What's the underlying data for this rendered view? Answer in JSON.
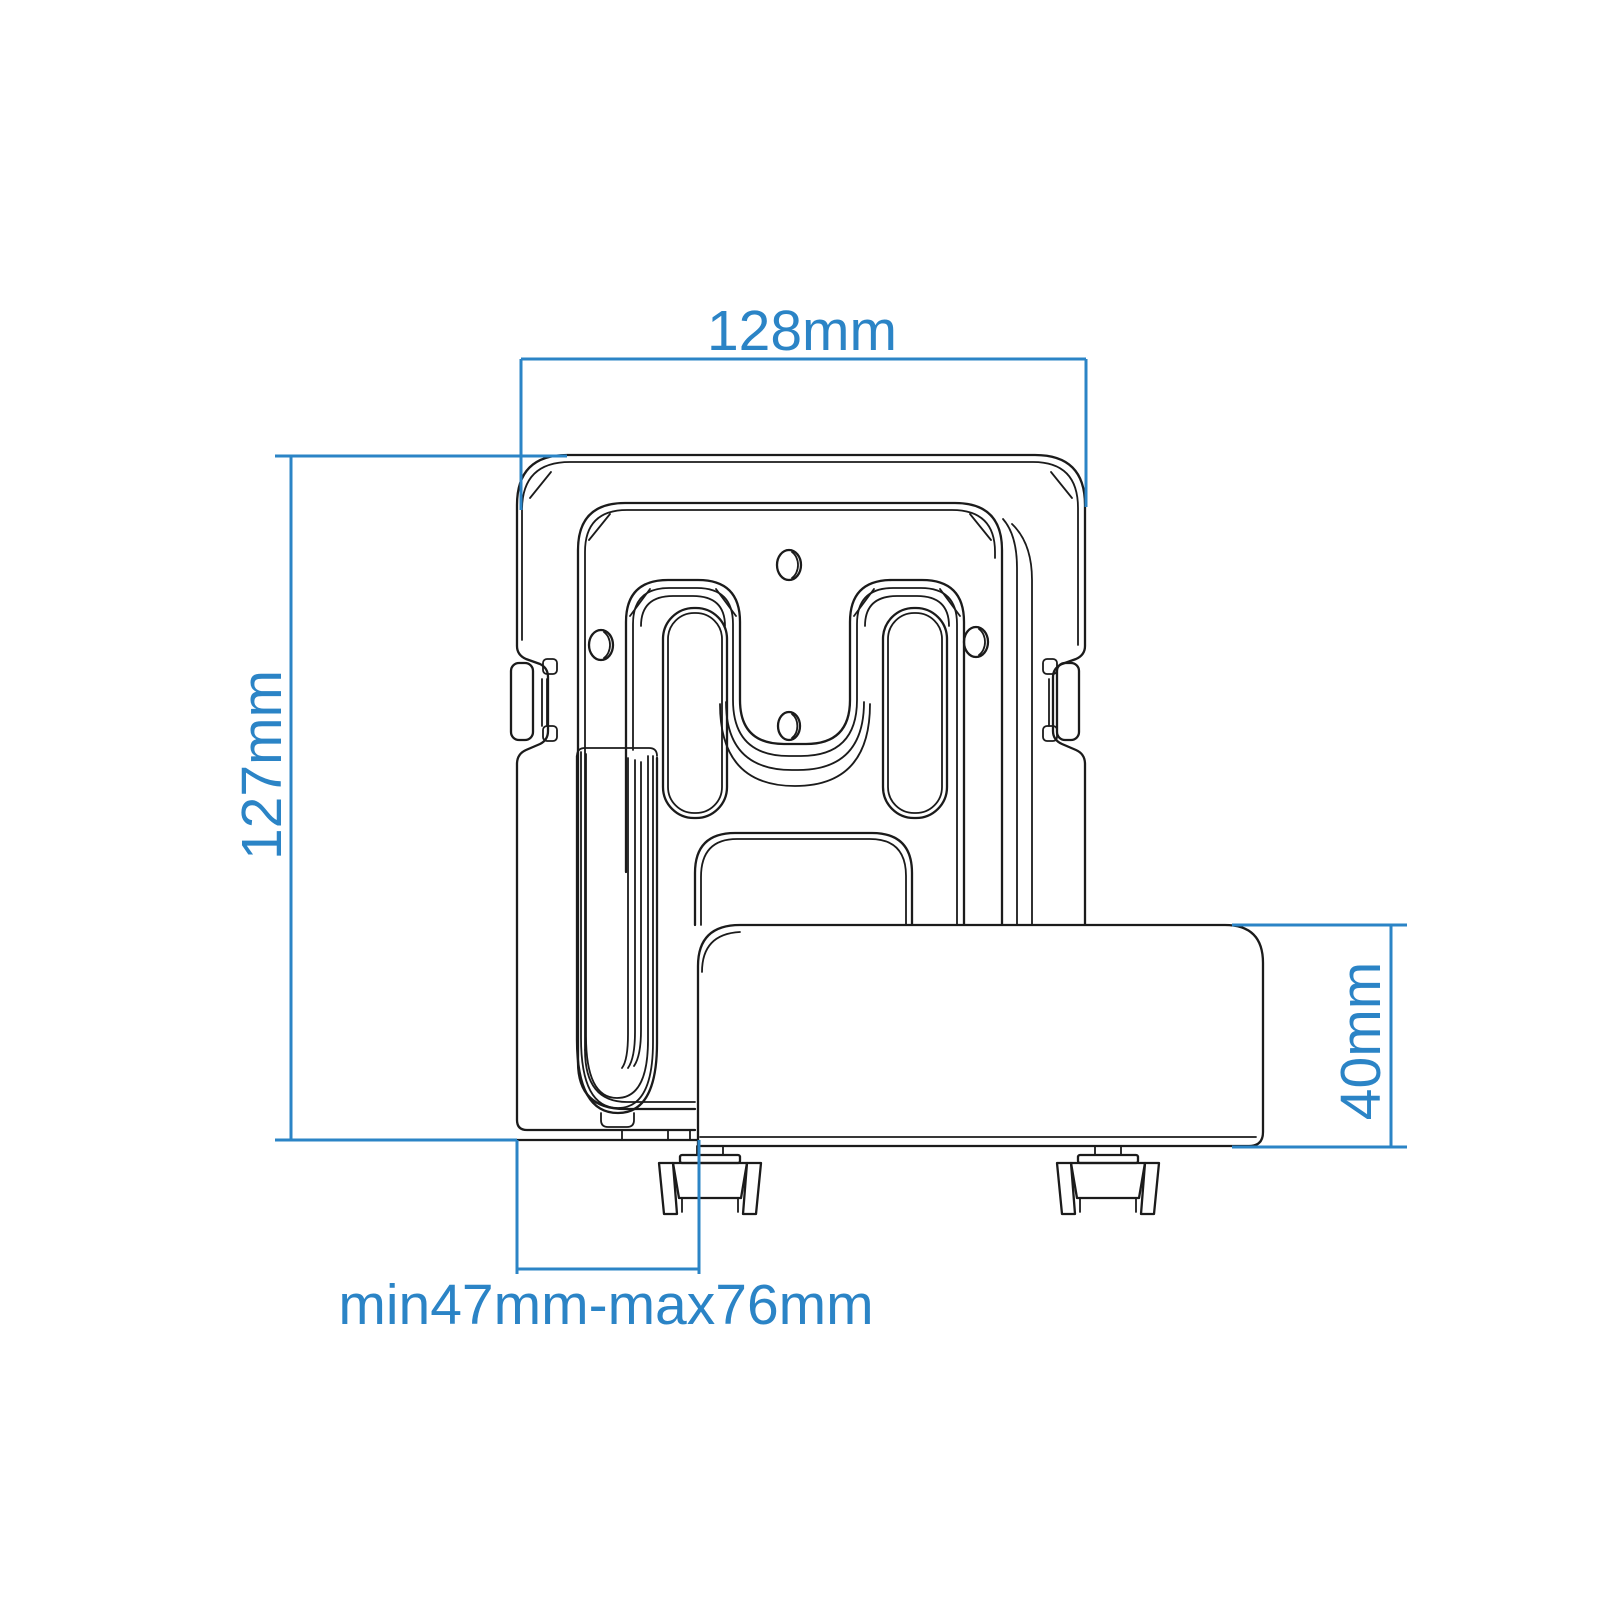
{
  "diagram": {
    "type": "technical-dimension-drawing",
    "subject": "universal streaming media player wall mount bracket with device box, front view",
    "background_color": "#ffffff",
    "line_color": "#1b1b1b",
    "dimension_color": "#2b84c6"
  },
  "dimensions": {
    "bracket_width": {
      "label": "128mm",
      "value_mm": 128,
      "orientation": "horizontal-top"
    },
    "bracket_height": {
      "label": "127mm",
      "value_mm": 127,
      "orientation": "vertical-left"
    },
    "device_height": {
      "label": "40mm",
      "value_mm": 40,
      "orientation": "vertical-right"
    },
    "depth_range": {
      "label": "min47mm-max76mm",
      "min_mm": 47,
      "max_mm": 76,
      "orientation": "horizontal-bottom"
    }
  }
}
